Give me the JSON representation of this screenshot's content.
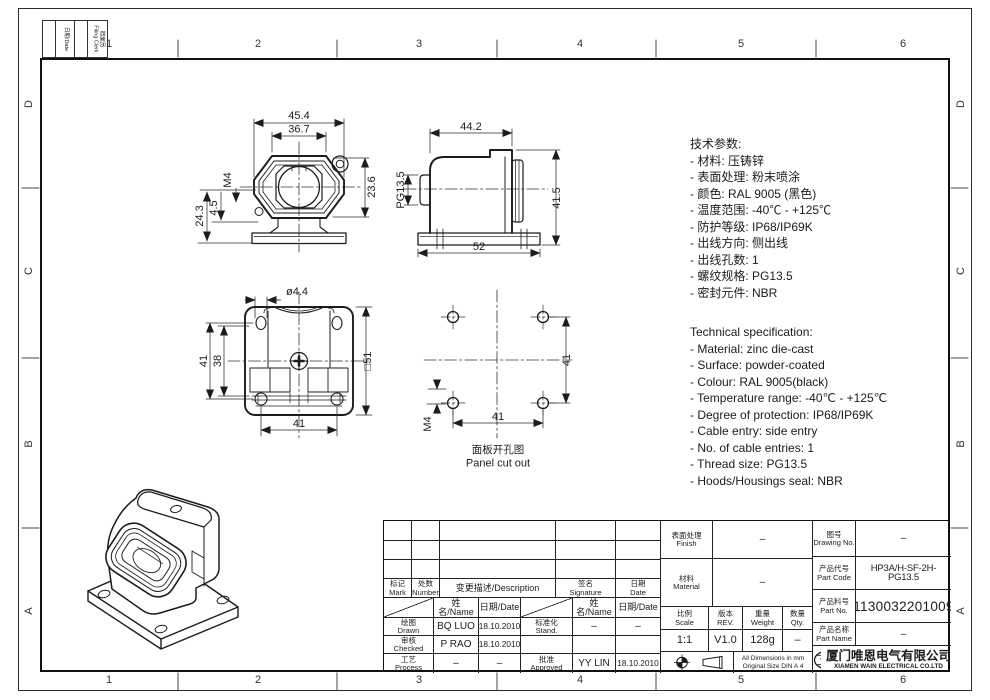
{
  "sheet": {
    "grid_columns": [
      "1",
      "2",
      "3",
      "4",
      "5",
      "6"
    ],
    "grid_rows": [
      "D",
      "C",
      "B",
      "A"
    ],
    "stamp_date_label": "日期/Date",
    "stamp_clerk_cn": "档案员",
    "stamp_clerk_en": "Filing Clerk"
  },
  "specs_cn": {
    "title": "技术参数:",
    "lines": [
      "- 材料: 压铸锌",
      "- 表面处理: 粉末喷涂",
      "- 颜色: RAL 9005 (黑色)",
      "- 温度范围: -40℃ - +125℃",
      "- 防护等级: IP68/IP69K",
      "- 出线方向: 侧出线",
      "- 出线孔数: 1",
      "- 螺纹规格: PG13.5",
      "- 密封元件: NBR"
    ]
  },
  "specs_en": {
    "title": "Technical specification:",
    "lines": [
      "- Material: zinc die-cast",
      "- Surface: powder-coated",
      "- Colour: RAL 9005(black)",
      "- Temperature range: -40℃ - +125℃",
      "- Degree of protection: IP68/IP69K",
      "- Cable entry: side entry",
      "- No. of cable entries: 1",
      "- Thread size: PG13.5",
      "- Hoods/Housings seal: NBR"
    ]
  },
  "views": {
    "front": {
      "dim_45_4": "45.4",
      "dim_36_7": "36.7",
      "dim_23_6": "23.6",
      "dim_m4": "M4",
      "dim_4_5": "4.5",
      "dim_24_3": "24.3"
    },
    "side": {
      "dim_44_2": "44.2",
      "dim_pg": "PG13.5",
      "dim_41_5": "41.5",
      "dim_52": "52"
    },
    "bottom": {
      "dim_dia": "ø4.4",
      "dim_41_left": "41",
      "dim_38": "38",
      "dim_sq": "□51",
      "dim_41_bottom": "41"
    },
    "panel": {
      "dim_41_right": "41",
      "dim_41_bottom": "41",
      "dim_m4": "M4",
      "caption_cn": "面板开孔图",
      "caption_en": "Panel cut out"
    }
  },
  "title_block": {
    "rev": {
      "mark_cn": "标记",
      "mark_en": "Mark",
      "number_cn": "处数",
      "number_en": "Number",
      "desc": "变更描述/Description",
      "sig_cn": "签名",
      "sig_en": "Signature",
      "date_cn": "日期",
      "date_en": "Date"
    },
    "people": {
      "name_hdr_1": "姓名/Name",
      "date_hdr_1": "日期/Date",
      "name_hdr_2": "姓名/Name",
      "date_hdr_2": "日期/Date",
      "drawn_cn": "绘图",
      "drawn_en": "Drawn",
      "drawn_name": "BQ LUO",
      "drawn_date": "18.10.2010",
      "checked_cn": "审核",
      "checked_en": "Checked",
      "checked_name": "P RAO",
      "checked_date": "18.10.2010",
      "process_cn": "工艺",
      "process_en": "Process",
      "process_name": "–",
      "process_date": "–",
      "stand_cn": "标准化",
      "stand_en": "Stand.",
      "stand_name": "–",
      "stand_date": "–",
      "approved_cn": "批准",
      "approved_en": "Approved",
      "approved_name": "YY LIN",
      "approved_date": "18.10.2010"
    },
    "info": {
      "finish_cn": "表面处理",
      "finish_en": "Finish",
      "finish_val": "–",
      "material_cn": "材料",
      "material_en": "Material",
      "material_val": "–",
      "scale_cn": "比例",
      "scale_en": "Scale",
      "scale_val": "1:1",
      "rev_cn": "版本",
      "rev_en": "REV.",
      "rev_val": "V1.0",
      "weight_cn": "重量",
      "weight_en": "Weight",
      "weight_val": "128g",
      "qty_cn": "数量",
      "qty_en": "Qty.",
      "qty_val": "–",
      "dims_note_1": "All Dimensions in mm",
      "dims_note_2": "Original Size DIN A 4"
    },
    "product": {
      "drawing_no_cn": "图号",
      "drawing_no_en": "Drawing No.",
      "drawing_no_val": "–",
      "part_code_cn": "产品代号",
      "part_code_en": "Part Code",
      "part_code_val": "HP3A/H-SF-2H-PG13.5",
      "part_no_cn": "产品料号",
      "part_no_en": "Part No.",
      "part_no_val": "1130032201009",
      "part_name_cn": "产品名称",
      "part_name_en": "Part Name",
      "part_name_val": "–"
    },
    "company": {
      "logo": "WAIN",
      "name_cn": "厦门唯恩电气有限公司",
      "name_en": "XIAMEN WAIN ELECTRICAL CO.LTD"
    }
  }
}
